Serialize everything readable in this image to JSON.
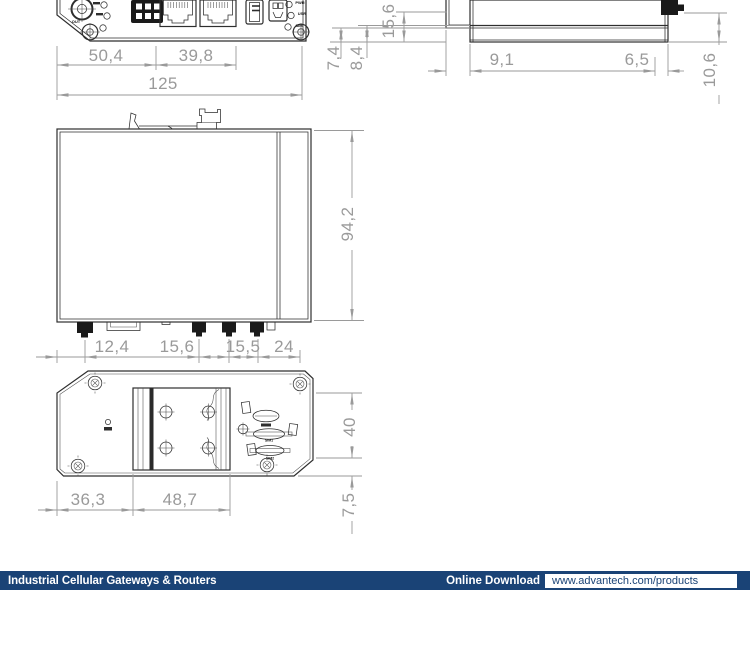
{
  "dimensions": {
    "front": {
      "seg1": "50,4",
      "seg2": "39,8",
      "total": "125"
    },
    "side": {
      "lip_small": "7,4",
      "lip_large": "8,4",
      "height": "15,6",
      "depth_left": "9,1",
      "depth_right": "6,5",
      "connector_height": "10,6"
    },
    "top": {
      "height": "94,2",
      "c1": "12,4",
      "c2": "15,6",
      "c3": "15,5",
      "c4": "24"
    },
    "rear": {
      "left": "36,3",
      "bracket": "48,7",
      "bracket_height": "40",
      "offset": "7,5"
    }
  },
  "panel_labels": {
    "antenna_out": "OUT",
    "led_pwr": "PWR",
    "led_usr": "USR",
    "led_sim": "SIM"
  },
  "rear_labels": {
    "sim1": "SIM1",
    "sim2": "SIM2"
  },
  "footer": {
    "title": "Industrial Cellular Gateways & Routers",
    "download_label": "Online Download",
    "url": "www.advantech.com/products"
  },
  "colors": {
    "footer_bar": "#1a4376",
    "dimension": "#9a9a9a",
    "outline": "#2e2e2e"
  }
}
